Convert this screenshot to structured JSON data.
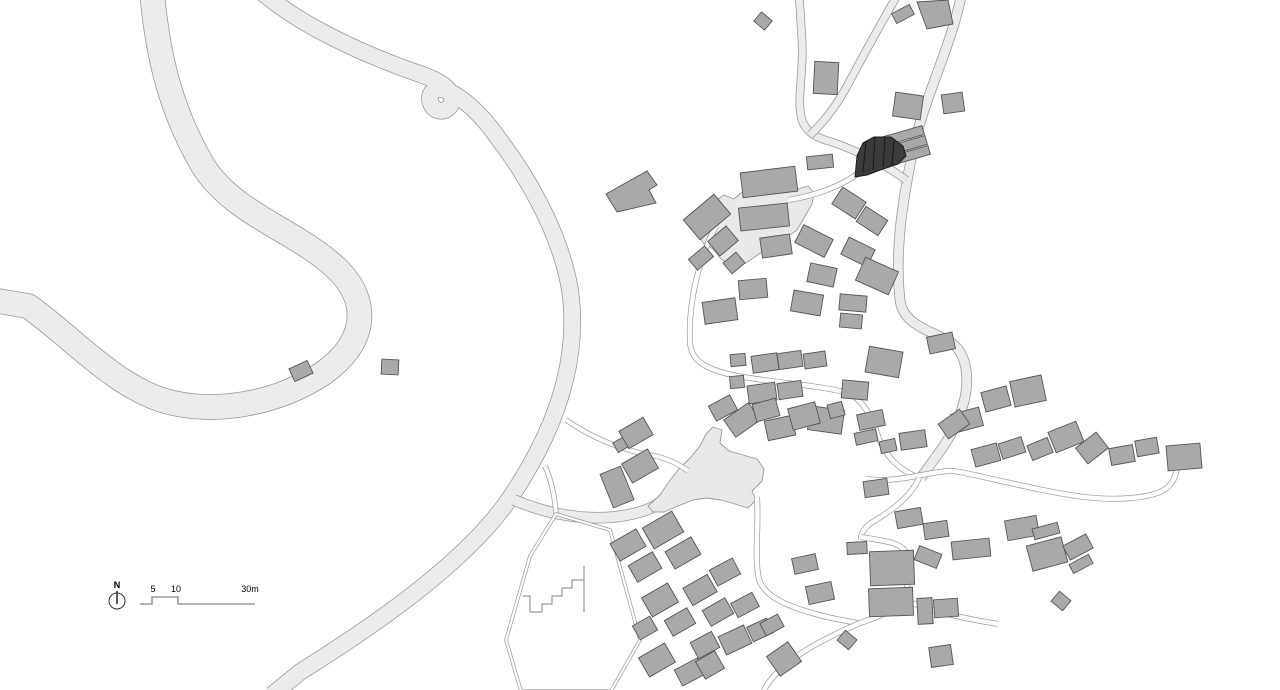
{
  "meta": {
    "drawing_type": "village site plan"
  },
  "canvas": {
    "w": 1280,
    "h": 690,
    "bg": "#ffffff"
  },
  "palette": {
    "road_fill": "#ececec",
    "road_stroke": "#9a9a9a",
    "lane_fill": "#fdfdfd",
    "plaza_fill": "#e9e9e9",
    "building_fill": "#a9a9a9",
    "building_stroke": "#555555",
    "dark_fill": "#3b3b3b",
    "dark_stroke": "#1c1c1c",
    "facet_stroke": "#161616",
    "text": "#222222"
  },
  "legend": {
    "north_label": "N",
    "scale_5": "5",
    "scale_10": "10",
    "scale_30": "30m"
  },
  "roads": [
    {
      "name": "serpentine-road-west",
      "w": 24,
      "d": "M 152,-8 C 158,60 172,112 202,164 C 232,214 296,230 336,268 C 372,302 366,344 322,374 C 278,403 214,416 162,400 C 112,384 66,332 28,306 L -8,300"
    },
    {
      "name": "main-road-center",
      "w": 16,
      "d": "M 262,-8 C 296,22 356,52 420,74 C 444,82 458,94 450,106 C 444,114 432,112 430,100 C 429,90 438,86 450,92 C 462,98 480,112 498,138 C 524,172 560,230 570,290 C 580,360 556,430 510,498 C 468,560 380,622 300,672 L 272,695"
    },
    {
      "name": "east-road",
      "w": 9,
      "d": "M 962,-8 C 952,45 925,95 913,150 C 901,208 895,255 900,300 C 903,325 930,330 950,342 C 968,353 970,382 963,405 C 953,440 932,460 921,478"
    },
    {
      "name": "north-access-road",
      "w": 7,
      "d": "M 799,-8 L 802,40 C 804,75 796,100 802,120 C 806,132 816,138 832,142 C 860,152 888,166 906,180"
    },
    {
      "name": "north-access-branch",
      "w": 7,
      "d": "M 810,135 C 824,122 836,106 846,88 C 862,58 880,25 898,-6"
    },
    {
      "name": "plaza-access-road",
      "w": 10,
      "d": "M 514,500 C 556,518 606,524 646,510 C 660,505 670,494 678,484"
    }
  ],
  "lanes": [
    {
      "name": "lane-dark-building",
      "w": 4.5,
      "d": "M 860,172 C 842,186 815,196 788,200"
    },
    {
      "name": "lane-village-west",
      "w": 4.5,
      "d": "M 716,226 C 700,256 688,300 690,342 C 691,360 704,368 728,374 C 762,382 812,384 844,392 C 860,396 870,412 878,436 C 886,458 900,470 919,478"
    },
    {
      "name": "lane-east",
      "w": 4.5,
      "d": "M 866,479 C 898,484 932,470 954,471 C 988,477 1038,491 1084,497 C 1118,501 1148,498 1162,491 C 1172,486 1176,477 1177,467"
    },
    {
      "name": "lane-south-connector",
      "w": 4.5,
      "d": "M 919,478 C 910,499 886,514 871,523 C 864,528 861,533 861,539"
    },
    {
      "name": "lane-hook",
      "w": 4.5,
      "d": "M 861,537 C 884,541 899,542 905,551 C 912,562 910,584 903,597 C 897,609 881,616 860,623"
    },
    {
      "name": "lane-plaza-south",
      "w": 4.5,
      "d": "M 757,497 C 759,528 754,558 759,579 C 764,597 789,607 819,615 C 834,619 847,621 858,623"
    },
    {
      "name": "lane-southwest-exit",
      "w": 4.5,
      "d": "M 860,623 C 832,635 801,651 783,667 C 771,678 765,686 763,694"
    },
    {
      "name": "lane-southeast-stub",
      "w": 4.5,
      "d": "M 903,599 C 928,611 962,618 998,624"
    },
    {
      "name": "lane-north-plaza",
      "w": 4,
      "d": "M 566,420 C 592,438 622,450 650,455 C 667,458 679,464 688,471"
    },
    {
      "name": "lane-parcel-stub",
      "w": 4,
      "d": "M 545,466 C 552,482 555,498 556,514"
    }
  ],
  "plazas": [
    {
      "name": "upper-plaza",
      "points": "712,203 724,195 734,199 742,192 798,189 808,186 814,193 812,204 804,218 797,230 786,238 772,245 759,254 746,263 733,266 721,259 713,249 703,243 699,234 705,222 701,212"
    },
    {
      "name": "village-plaza",
      "points": "648,506 660,495 668,483 678,470 690,458 700,446 706,434 713,427 722,430 720,443 729,451 743,455 757,459 764,469 762,481 752,491 756,500 748,508 735,504 721,500 707,498 693,500 678,506 664,512 653,512"
    }
  ],
  "parcel": {
    "outline": "M 556,514 L 610,530 L 640,640 L 611,691 L 521,691 L 506,640 L 530,556 Z",
    "zigzag": "M 584,566 L 584,612 M 584,580 L 572,580 L 572,588 L 562,588 L 562,596 L 552,596 L 552,604 L 542,604 L 542,612 L 530,612 L 530,596 L 523,596"
  },
  "buildings": [
    [
      763,
      21,
      14,
      12,
      40
    ],
    [
      826,
      78,
      24,
      32,
      3
    ],
    [
      903,
      14,
      20,
      11,
      -28
    ],
    [
      908,
      106,
      28,
      24,
      8
    ],
    [
      953,
      103,
      21,
      19,
      -8
    ],
    [
      902,
      136,
      44,
      9,
      -16
    ],
    [
      905,
      146,
      44,
      9,
      -16
    ],
    [
      908,
      156,
      44,
      9,
      -16
    ],
    [
      820,
      162,
      26,
      13,
      -6
    ],
    [
      769,
      182,
      55,
      25,
      -7
    ],
    [
      764,
      217,
      49,
      23,
      -6
    ],
    [
      707,
      217,
      40,
      26,
      -40
    ],
    [
      723,
      241,
      24,
      19,
      -40
    ],
    [
      734,
      263,
      17,
      14,
      -40
    ],
    [
      701,
      258,
      21,
      14,
      -40
    ],
    [
      849,
      203,
      28,
      20,
      33
    ],
    [
      872,
      221,
      26,
      18,
      33
    ],
    [
      814,
      241,
      33,
      20,
      27
    ],
    [
      858,
      252,
      29,
      19,
      26
    ],
    [
      877,
      276,
      36,
      25,
      24
    ],
    [
      776,
      246,
      30,
      20,
      -8
    ],
    [
      753,
      289,
      28,
      19,
      -5
    ],
    [
      807,
      303,
      30,
      21,
      10
    ],
    [
      822,
      275,
      27,
      19,
      12
    ],
    [
      720,
      311,
      33,
      22,
      -8
    ],
    [
      853,
      303,
      27,
      16,
      5
    ],
    [
      851,
      321,
      22,
      14,
      5
    ],
    [
      941,
      343,
      26,
      17,
      -12
    ],
    [
      301,
      371,
      20,
      14,
      -25
    ],
    [
      390,
      367,
      17,
      15,
      3
    ],
    [
      738,
      360,
      15,
      12,
      -5
    ],
    [
      737,
      382,
      14,
      12,
      -5
    ],
    [
      765,
      363,
      26,
      17,
      -8
    ],
    [
      790,
      360,
      24,
      16,
      -8
    ],
    [
      815,
      360,
      22,
      15,
      -8
    ],
    [
      762,
      393,
      28,
      18,
      -8
    ],
    [
      790,
      390,
      24,
      16,
      -8
    ],
    [
      742,
      420,
      30,
      21,
      -35
    ],
    [
      780,
      428,
      28,
      20,
      -12
    ],
    [
      826,
      420,
      34,
      24,
      8
    ],
    [
      855,
      390,
      26,
      18,
      5
    ],
    [
      884,
      362,
      34,
      26,
      10
    ],
    [
      967,
      420,
      29,
      19,
      -15
    ],
    [
      996,
      399,
      26,
      20,
      -15
    ],
    [
      1028,
      391,
      32,
      26,
      -12
    ],
    [
      913,
      440,
      26,
      17,
      -8
    ],
    [
      954,
      424,
      26,
      18,
      -35
    ],
    [
      986,
      455,
      26,
      18,
      -15
    ],
    [
      1012,
      448,
      24,
      16,
      -18
    ],
    [
      1040,
      449,
      22,
      16,
      -22
    ],
    [
      1066,
      437,
      30,
      22,
      -22
    ],
    [
      1092,
      448,
      26,
      20,
      -38
    ],
    [
      1122,
      455,
      24,
      17,
      -10
    ],
    [
      1147,
      447,
      22,
      16,
      -10
    ],
    [
      1184,
      457,
      34,
      25,
      -5
    ],
    [
      909,
      518,
      26,
      17,
      -10
    ],
    [
      936,
      530,
      24,
      16,
      -8
    ],
    [
      971,
      549,
      38,
      18,
      -6
    ],
    [
      928,
      557,
      24,
      15,
      22
    ],
    [
      1022,
      528,
      32,
      20,
      -10
    ],
    [
      1046,
      531,
      26,
      11,
      -15
    ],
    [
      1047,
      554,
      36,
      26,
      -15
    ],
    [
      1078,
      547,
      26,
      16,
      -28
    ],
    [
      1081,
      564,
      22,
      10,
      -28
    ],
    [
      1061,
      601,
      15,
      13,
      40
    ],
    [
      723,
      408,
      24,
      17,
      -28
    ],
    [
      766,
      410,
      24,
      18,
      -15
    ],
    [
      804,
      416,
      28,
      22,
      -15
    ],
    [
      836,
      410,
      15,
      14,
      -15
    ],
    [
      871,
      420,
      26,
      16,
      -12
    ],
    [
      866,
      437,
      22,
      12,
      -12
    ],
    [
      888,
      446,
      16,
      12,
      -12
    ],
    [
      876,
      488,
      24,
      16,
      -8
    ],
    [
      622,
      444,
      15,
      11,
      -30
    ],
    [
      636,
      433,
      28,
      20,
      -30
    ],
    [
      640,
      466,
      30,
      22,
      -30
    ],
    [
      617,
      487,
      22,
      36,
      -22
    ],
    [
      628,
      545,
      30,
      20,
      -30
    ],
    [
      645,
      567,
      28,
      19,
      -30
    ],
    [
      663,
      530,
      34,
      24,
      -30
    ],
    [
      683,
      553,
      30,
      20,
      -30
    ],
    [
      660,
      600,
      30,
      22,
      -30
    ],
    [
      680,
      622,
      26,
      18,
      -30
    ],
    [
      645,
      628,
      20,
      16,
      -30
    ],
    [
      657,
      660,
      30,
      22,
      -30
    ],
    [
      690,
      672,
      26,
      18,
      -28
    ],
    [
      700,
      590,
      28,
      20,
      -30
    ],
    [
      718,
      612,
      26,
      18,
      -30
    ],
    [
      705,
      645,
      24,
      18,
      -28
    ],
    [
      725,
      572,
      26,
      18,
      -28
    ],
    [
      745,
      605,
      24,
      16,
      -28
    ],
    [
      735,
      640,
      28,
      20,
      -25
    ],
    [
      760,
      630,
      22,
      16,
      -25
    ],
    [
      710,
      665,
      22,
      20,
      -30
    ],
    [
      784,
      659,
      26,
      24,
      -35
    ],
    [
      772,
      625,
      20,
      14,
      -28
    ],
    [
      805,
      564,
      24,
      16,
      -12
    ],
    [
      820,
      593,
      26,
      18,
      -12
    ],
    [
      857,
      548,
      20,
      12,
      -3
    ],
    [
      892,
      568,
      44,
      34,
      -2
    ],
    [
      891,
      602,
      44,
      28,
      -2
    ],
    [
      925,
      611,
      15,
      26,
      -3
    ],
    [
      946,
      608,
      24,
      18,
      -4
    ],
    [
      847,
      640,
      15,
      13,
      40
    ],
    [
      941,
      656,
      22,
      20,
      -8
    ]
  ],
  "building_polys": [
    {
      "name": "wedge-building-north",
      "points": "917,2 948,0 953,24 927,29"
    },
    {
      "name": "l-shaped-building-west",
      "points": "606,194 647,171 657,185 649,190 656,203 617,212"
    }
  ],
  "highlight_building": {
    "outline": "855,177 857,156 863,143 874,137 891,137 903,146 906,156 898,164 883,169 867,175",
    "facets": [
      "M 866,141 L 863,172",
      "M 875,137 L 873,170",
      "M 885,138 L 883,167",
      "M 894,141 L 892,165"
    ]
  },
  "north_arrow": {
    "cx": 117,
    "cy": 601,
    "r": 8
  },
  "scale_bar": {
    "d": "M 140,604 L 152,604 L 152,597 L 178,597 L 178,604 L 255,604"
  }
}
